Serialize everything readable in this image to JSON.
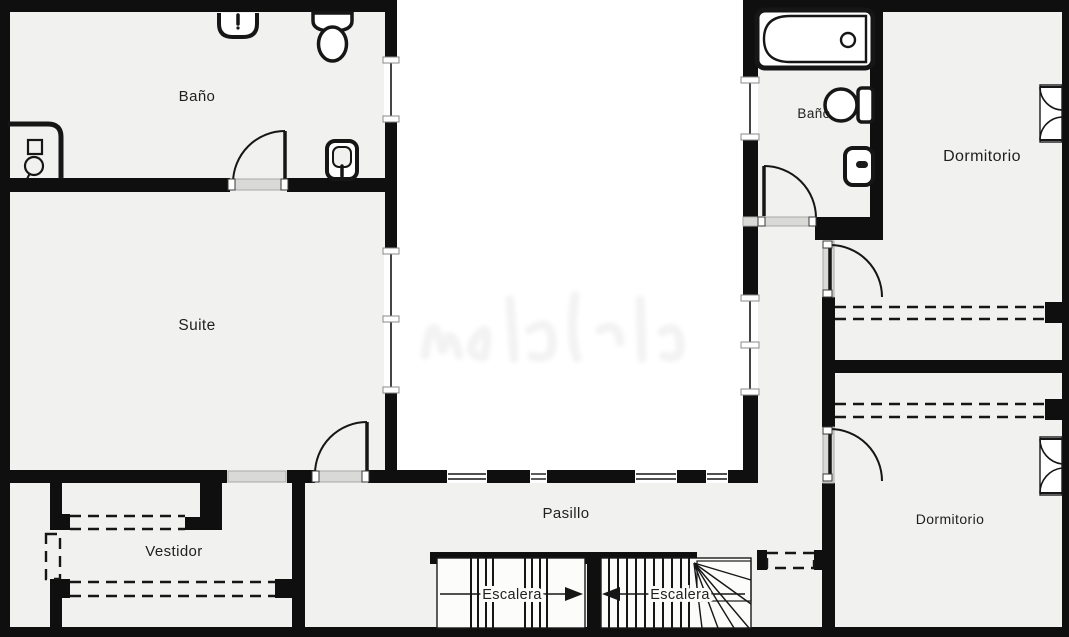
{
  "title": "Floor plan",
  "colors": {
    "wall": "#0f0f0f",
    "floor": "#f1f1ef",
    "void": "#ffffff",
    "threshold": "#d9d9d7",
    "stair": "#fcfcfb",
    "line": "#161616",
    "text": "#1f1f1f"
  },
  "rooms": {
    "bathroom_main": {
      "label": "Baño"
    },
    "suite": {
      "label": "Suite"
    },
    "closet": {
      "label": "Vestidor"
    },
    "hallway": {
      "label": "Pasillo"
    },
    "bathroom_second": {
      "label": "Baño"
    },
    "bedroom_top": {
      "label": "Dormitorio"
    },
    "bedroom_bottom": {
      "label": "Dormitorio"
    },
    "stair_left": {
      "label": "Escalera"
    },
    "stair_right": {
      "label": "Escalera"
    }
  },
  "fixtures": [
    "sink-icon",
    "toilet-icon",
    "shower-icon",
    "bidet-icon",
    "bathtub-icon",
    "wardrobe-dashed-icon",
    "casement-window-icon",
    "door-swing-icon",
    "window-strip-icon",
    "stair-arrow-icon"
  ]
}
